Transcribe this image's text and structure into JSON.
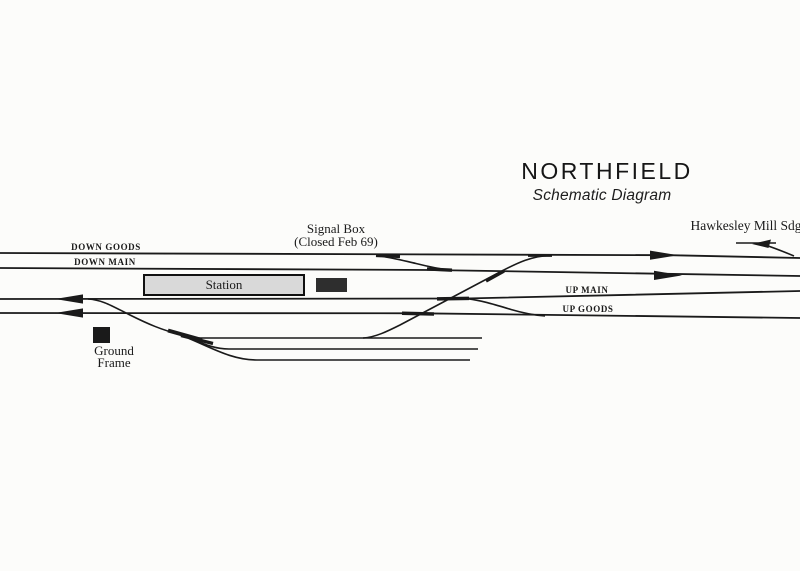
{
  "diagram": {
    "title": "NORTHFIELD",
    "subtitle": "Schematic Diagram",
    "siding_label": "Hawkesley Mill Sdg",
    "signal_box": {
      "line1": "Signal Box",
      "line2": "(Closed Feb 69)"
    },
    "station_label": "Station",
    "ground_frame": {
      "line1": "Ground",
      "line2": "Frame"
    },
    "track_labels": {
      "down_goods": "DOWN GOODS",
      "down_main": "DOWN MAIN",
      "up_main": "UP MAIN",
      "up_goods": "UP GOODS"
    },
    "colors": {
      "ink": "#1a1a1a",
      "paper": "#fcfcfa",
      "station_fill": "#d9d9d9",
      "signal_box_fill": "#2e2e2e"
    }
  }
}
